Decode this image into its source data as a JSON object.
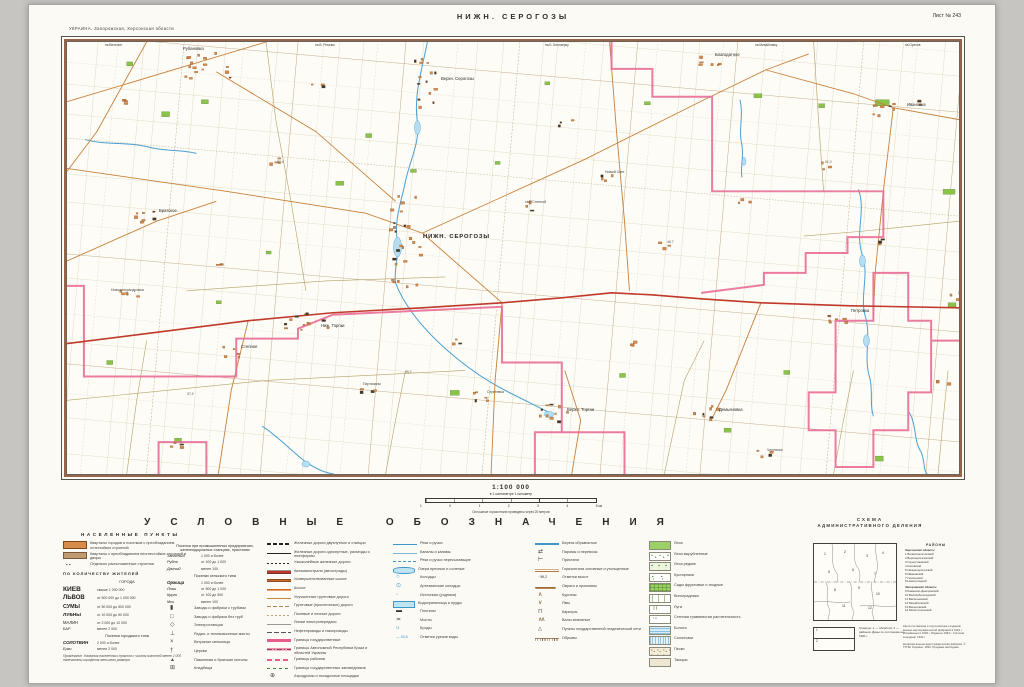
{
  "page": {
    "region_line": "УКРАИНА. Запорожская, Херсонская области",
    "title": "НИЖН. СЕРОГОЗЫ",
    "sheet_no": "Лист № 243"
  },
  "scale": {
    "ratio": "1:100 000",
    "sub": "в 1 сантиметре 1 километр",
    "bar_labels": [
      "1",
      "0",
      "1",
      "2",
      "3",
      "4",
      "5 км"
    ],
    "note": "Сплошные горизонтали проведены через 20 метров"
  },
  "legend_title": "УСЛОВНЫЕ ОБОЗНАЧЕНИЯ",
  "legend": {
    "settlements_header": "НАСЕЛЕННЫЕ ПУНКТЫ",
    "col1_rows": [
      {
        "sw": "blk-or",
        "label": "Кварталы городов и поселков с преобладанием огнестойких строений"
      },
      {
        "sw": "blk-br",
        "label": "Кварталы с преобладанием неогнестойких строений и дворы"
      },
      {
        "sw": "dots2",
        "label": "Отдельно расположенные строения"
      }
    ],
    "by_population_header": "ПО КОЛИЧЕСТВУ ЖИТЕЛЕЙ",
    "cities_header": "ГОРОДА",
    "cities": [
      {
        "name": "КИЕВ",
        "ncls": "n1",
        "desc": "свыше 1 000 000"
      },
      {
        "name": "ЛЬВОВ",
        "ncls": "n2",
        "desc": "от 500 000 до 1 000 000"
      },
      {
        "name": "СУМЫ",
        "ncls": "n3",
        "desc": "от 50 000 до 500 000"
      },
      {
        "name": "ЛУБНЫ",
        "ncls": "n4",
        "desc": "от 10 000 до 50 000"
      },
      {
        "name": "МАЛИН",
        "ncls": "n5",
        "desc": "от 2 000 до 10 000"
      },
      {
        "name": "БАР",
        "ncls": "n6",
        "desc": "менее 2 000"
      }
    ],
    "pgt_header": "Поселки городского типа",
    "pgt": [
      {
        "name": "СОЛОТВИН",
        "ncls": "n7",
        "desc": "2 000 и более"
      },
      {
        "name": "Ерки",
        "ncls": "n8",
        "desc": "менее 2 000"
      }
    ],
    "note": "Примечание. Названия населенных пунктов с числом жителей менее 2 000 напечатаны шрифтом меньшего размера.",
    "industry_header": "Поселки при промышленных предприятиях, железнодорожных станциях, пристанях",
    "industry": [
      {
        "name": "Западный",
        "ncls": "n8",
        "desc": "1 000 и более"
      },
      {
        "name": "Рудня",
        "ncls": "n8",
        "desc": "от 100 до 1 000"
      },
      {
        "name": "Дачный",
        "ncls": "n8",
        "desc": "менее 100"
      }
    ],
    "rural_header": "Поселки сельского типа",
    "rural": [
      {
        "name": "Оржица",
        "ncls": "n7",
        "desc": "1 000 и более"
      },
      {
        "name": "Лозы",
        "ncls": "n8",
        "desc": "от 500 до 1 000"
      },
      {
        "name": "Круги",
        "ncls": "n8",
        "desc": "от 100 до 500"
      },
      {
        "name": "Мхи",
        "ncls": "n8",
        "desc": "менее 100"
      }
    ],
    "objects": [
      {
        "sw": "chimney",
        "label": "Заводы и фабрики с трубами"
      },
      {
        "sw": "plant",
        "label": "Заводы и фабрики без труб"
      },
      {
        "sw": "power",
        "label": "Электростанции"
      },
      {
        "sw": "mast",
        "label": "Радио- и телевизионные мачты"
      },
      {
        "sw": "wind",
        "label": "Ветряные мельницы"
      },
      {
        "sw": "church",
        "label": "Церкви"
      },
      {
        "sw": "monument",
        "label": "Памятники и братские могилы"
      },
      {
        "sw": "cemetery",
        "label": "Кладбища"
      }
    ],
    "col2_rows": [
      {
        "sw": "rail2",
        "label": "Железные дороги двухпутные и станции"
      },
      {
        "sw": "rail1",
        "label": "Железные дороги однопутные, разъезды и платформы"
      },
      {
        "sw": "railn",
        "label": "Узкоколейные железные дороги"
      },
      {
        "sw": "road-a",
        "label": "Автомагистрали (автострады)"
      },
      {
        "sw": "road-sh",
        "label": "Усовершенствованные шоссе"
      },
      {
        "sw": "road-s",
        "label": "Шоссе"
      },
      {
        "sw": "road-im",
        "label": "Улучшенные грунтовые дороги"
      },
      {
        "sw": "road-gr",
        "label": "Грунтовые (проселочные) дороги"
      },
      {
        "sw": "road-fl",
        "label": "Полевые и лесные дороги"
      },
      {
        "sw": "lep",
        "label": "Линии электропередачи"
      },
      {
        "sw": "pipe",
        "label": "Нефтепроводы и газопроводы"
      },
      {
        "sw": "bnd-state",
        "label": "Границы государственные"
      },
      {
        "sw": "bnd-obl",
        "label": "Границы Автономной Республики Крым и областей Украины"
      },
      {
        "sw": "bnd-ray",
        "label": "Границы районов"
      },
      {
        "sw": "bnd-zap",
        "label": "Границы государственных заповедников"
      },
      {
        "sw": "airfield",
        "label": "Аэродромы и посадочные площадки"
      }
    ],
    "col3_rows": [
      {
        "sw": "riv",
        "label": "Реки и ручьи"
      },
      {
        "sw": "can",
        "label": "Каналы и канавы"
      },
      {
        "sw": "riv-dry",
        "label": "Реки и ручьи пересыхающие"
      },
      {
        "sw": "lake",
        "label": "Озера пресные и соленые"
      },
      {
        "sw": "well",
        "label": "Колодцы"
      },
      {
        "sw": "art",
        "label": "Артезианские колодцы"
      },
      {
        "sw": "spring",
        "label": "Источники (родники)"
      },
      {
        "sw": "pond",
        "label": "Водохранилища и пруды"
      },
      {
        "sw": "dam",
        "label": "Плотины"
      },
      {
        "sw": "bridge",
        "label": "Мосты"
      },
      {
        "sw": "ford",
        "label": "Броды"
      },
      {
        "sw": "urez",
        "label": "Отметки урезов воды"
      }
    ],
    "col4_rows": [
      {
        "sw": "bank",
        "label": "Берега обрывистые"
      },
      {
        "sw": "ferry",
        "label": "Паромы и перевозы"
      },
      {
        "sw": "pier",
        "label": "Пристани"
      },
      {
        "sw": "cnt",
        "label": "Горизонтали основные и утолщенные"
      },
      {
        "sw": "hgt",
        "label": "Отметки высот"
      },
      {
        "sw": "ovr",
        "label": "Овраги и промоины"
      },
      {
        "sw": "kur",
        "label": "Курганы"
      },
      {
        "sw": "pit",
        "label": "Ямы"
      },
      {
        "sw": "quarry",
        "label": "Карьеры"
      },
      {
        "sw": "mound",
        "label": "Валы земляные"
      },
      {
        "sw": "tri",
        "label": "Пункты государственной геодезической сети"
      },
      {
        "sw": "cliff",
        "label": "Обрывы"
      }
    ],
    "col5_rows": [
      {
        "sw": "forest",
        "label": "Леса"
      },
      {
        "sw": "forest-cut",
        "label": "Леса вырубленные"
      },
      {
        "sw": "forest-rare",
        "label": "Леса редкие"
      },
      {
        "sw": "shrub",
        "label": "Кустарники"
      },
      {
        "sw": "garden",
        "label": "Сады фруктовые и ягодные"
      },
      {
        "sw": "vine",
        "label": "Виноградники"
      },
      {
        "sw": "meadow",
        "label": "Луга"
      },
      {
        "sw": "steppe",
        "label": "Степная травянистая растительность"
      },
      {
        "sw": "swamp",
        "label": "Болота"
      },
      {
        "sw": "salt",
        "label": "Солончаки"
      },
      {
        "sw": "sand",
        "label": "Пески"
      },
      {
        "sw": "takyr",
        "label": "Такыры"
      }
    ]
  },
  "admin": {
    "title1": "СХЕМА",
    "title2": "АДМИНИСТРАТИВНОГО ДЕЛЕНИЯ",
    "districts_header": "РАЙОНЫ",
    "oblast1": "Херсонская область:",
    "list1": [
      "1 Великолепетихский",
      "2 Верхнерогачикский",
      "3 Горностаевский",
      "4 Каховский",
      "5 Нижнесерогозский",
      "6 Ивановский",
      "7 Генический",
      "8 Новотроицкий"
    ],
    "oblast2": "Запорожская область:",
    "list2": [
      "9 Каменско-Днепровский",
      "10 Великобелозерский",
      "11 Васильевский",
      "12 Михайловский",
      "13 Веселовский",
      "14 Мелитопольский"
    ],
    "inset_numbers": [
      {
        "t": "1",
        "x": 10,
        "y": 8
      },
      {
        "t": "2",
        "x": 30,
        "y": 6
      },
      {
        "t": "3",
        "x": 52,
        "y": 10
      },
      {
        "t": "4",
        "x": 68,
        "y": 7
      },
      {
        "t": "5",
        "x": 14,
        "y": 26
      },
      {
        "t": "6",
        "x": 38,
        "y": 24
      },
      {
        "t": "7",
        "x": 60,
        "y": 28
      },
      {
        "t": "8",
        "x": 20,
        "y": 44
      },
      {
        "t": "9",
        "x": 44,
        "y": 42
      },
      {
        "t": "10",
        "x": 62,
        "y": 48
      },
      {
        "t": "11",
        "x": 28,
        "y": 60
      },
      {
        "t": "12",
        "x": 54,
        "y": 62
      }
    ],
    "keybox_items": [
      "1",
      "2"
    ],
    "key_caption": "Границы: 1 — областей, 2 — районов. Даны по состоянию на 1991 г.",
    "imprint1": "Карта составлена и подготовлена к изданию военно-картографической фабрикой в 1991 г. Исправлена в 1993 г. Издана в 1994 г. Система координат 1942 г.",
    "imprint2": "Киевская военно-картографическая фабрика. © ГУГКК Украины, 1994. Продажа свободная."
  },
  "map_labels": [
    {
      "t": "НИЖН. СЕРОГОЗЫ",
      "x": 356,
      "y": 192,
      "cls": "major"
    },
    {
      "t": "Рубановка",
      "x": 116,
      "y": 4,
      "cls": "name"
    },
    {
      "t": "Верхн. Серогозы",
      "x": 374,
      "y": 34,
      "cls": "name"
    },
    {
      "t": "Ниж. Торгаи",
      "x": 254,
      "y": 281,
      "cls": "name"
    },
    {
      "t": "Верхн. Торгаи",
      "x": 500,
      "y": 365,
      "cls": "name"
    },
    {
      "t": "Демьяновка",
      "x": 652,
      "y": 365,
      "cls": "name"
    },
    {
      "t": "Ивановка",
      "x": 840,
      "y": 60,
      "cls": "name"
    },
    {
      "t": "Благодатное",
      "x": 648,
      "y": 10,
      "cls": "name"
    },
    {
      "t": "Петровка",
      "x": 784,
      "y": 266,
      "cls": "name"
    },
    {
      "t": "Братское",
      "x": 92,
      "y": 166,
      "cls": "name"
    },
    {
      "t": "Степное",
      "x": 174,
      "y": 302,
      "cls": "name"
    },
    {
      "t": "Сергеевка",
      "x": 420,
      "y": 348,
      "cls": "small"
    },
    {
      "t": "Чернянка",
      "x": 700,
      "y": 406,
      "cls": "small"
    },
    {
      "t": "Партизаны",
      "x": 296,
      "y": 340,
      "cls": "small"
    },
    {
      "t": "Новый Свет",
      "x": 538,
      "y": 128,
      "cls": "small"
    },
    {
      "t": "свх. Степной",
      "x": 458,
      "y": 158,
      "cls": "small"
    },
    {
      "t": "Новоалександровка",
      "x": 44,
      "y": 246,
      "cls": "small"
    },
    {
      "t": "52,4",
      "x": 210,
      "y": 118,
      "cls": "elev"
    },
    {
      "t": "48,7",
      "x": 600,
      "y": 198,
      "cls": "elev"
    },
    {
      "t": "61,0",
      "x": 758,
      "y": 118,
      "cls": "elev"
    },
    {
      "t": "45,2",
      "x": 338,
      "y": 328,
      "cls": "elev"
    },
    {
      "t": "57,9",
      "x": 120,
      "y": 350,
      "cls": "elev"
    },
    {
      "t": "на Веселое",
      "x": 38,
      "y": 1,
      "cls": "edge"
    },
    {
      "t": "на В. Рогачик",
      "x": 248,
      "y": 1,
      "cls": "edge"
    },
    {
      "t": "на Б. Белозерку",
      "x": 478,
      "y": 1,
      "cls": "edge"
    },
    {
      "t": "на Михайловку",
      "x": 688,
      "y": 1,
      "cls": "edge"
    },
    {
      "t": "на Орехов",
      "x": 838,
      "y": 1,
      "cls": "edge"
    }
  ]
}
